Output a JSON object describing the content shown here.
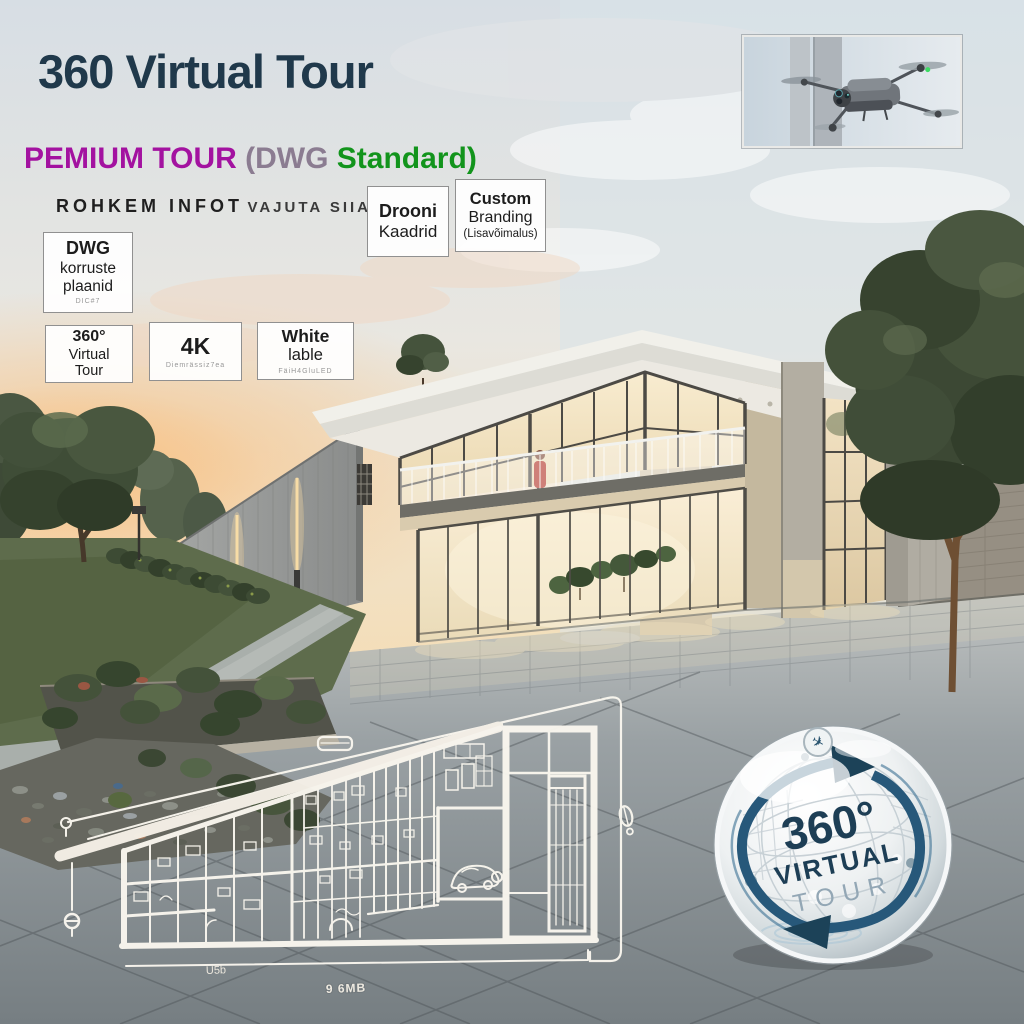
{
  "poster": {
    "title": "360 Virtual Tour",
    "subtitle": {
      "premium": "PEMIUM TOUR ",
      "open": "(",
      "dwg": "DWG",
      "standard": " Standard",
      "close": ")"
    },
    "info": {
      "strong": "ROHKEM INFOT",
      "rest": "VAJUTA SIIA"
    }
  },
  "features": {
    "drooni": {
      "line1": "Drooni",
      "line2": "Kaadrid"
    },
    "custom": {
      "line1": "Custom",
      "line2": "Branding",
      "line3": "(Lisavõimalus)"
    },
    "dwg": {
      "line1": "DWG",
      "line2": "korruste",
      "line3": "plaanid",
      "tiny": "DIC#7"
    },
    "tour360": {
      "line1": "360°",
      "line2": "Virtual",
      "line3": "Tour"
    },
    "fourk": {
      "line1": "4K",
      "tiny": "Diemrässiz7ea"
    },
    "white": {
      "line1": "White",
      "line2": "lable",
      "tiny": "FäiH4GluLED"
    }
  },
  "plan": {
    "label_left": "U5b",
    "label_bottom": "9 6MB"
  },
  "badge": {
    "deg": "360°",
    "virtual": "VIRTUAL",
    "tour": "TOUR"
  },
  "icons": {
    "top_right": "drone-photo",
    "badge_top": "plane-icon",
    "plane_glyph": "✈"
  },
  "colors": {
    "title": "#20394B",
    "magenta": "#A312A0",
    "gray_purple": "#8B7C91",
    "green": "#12941C",
    "box_border": "#909090",
    "badge_teal": "#27587A",
    "badge_tour_gray": "#93A7B5",
    "warm_glass": "#F6E8C8",
    "sunset": "#F6C48E"
  }
}
